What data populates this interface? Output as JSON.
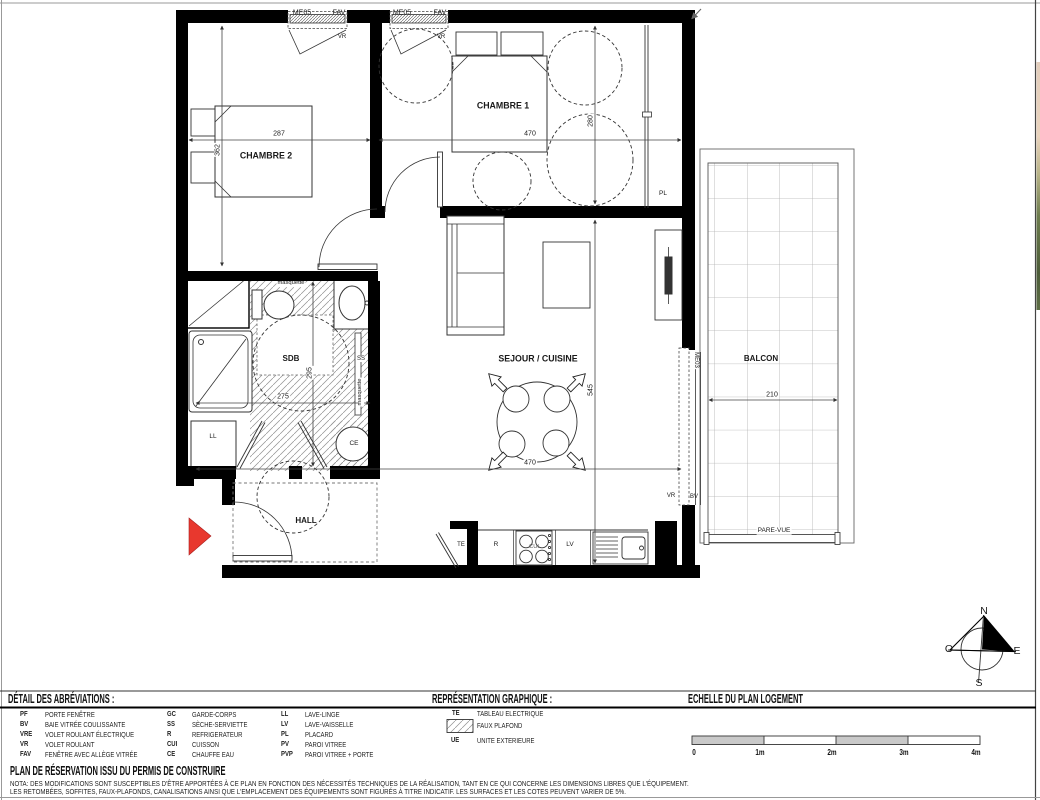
{
  "plan": {
    "windows": {
      "w1_code": "ME05",
      "w1_type": "FAV",
      "w1_shutter": "VR",
      "w2_code": "ME05",
      "w2_type": "FAV",
      "w2_shutter": "VR",
      "balcony_door_code": "ME03",
      "balcony_door_shutter": "VR",
      "balcony_door_type": "BV"
    },
    "rooms": {
      "chambre1": "CHAMBRE 1",
      "chambre2": "CHAMBRE 2",
      "sdb": "SDB",
      "sejour_cuisine": "SEJOUR / CUISINE",
      "hall": "HALL",
      "balcon": "BALCON"
    },
    "dims_cm": {
      "chambre1_width": "470",
      "chambre1_depth": "280",
      "chambre2_width": "287",
      "chambre2_depth": "362",
      "sdb_width": "275",
      "sdb_depth": "295",
      "sejour_width": "470",
      "sejour_depth": "545",
      "balcon_width": "210"
    },
    "equipment": {
      "placard": "PL",
      "seche_serviette": "SS",
      "lave_linge": "LL",
      "chauffe_eau": "CE",
      "tableau_electrique": "TE",
      "refrigerateur": "R",
      "cuisson": "CUI",
      "lave_vaisselle": "LV"
    },
    "annotations": {
      "masquette_top": "masquette",
      "masquette_side": "masquette",
      "pare_vue": "PARE-VUE"
    }
  },
  "compass": {
    "north": "N",
    "west": "O",
    "east": "E",
    "south": "S"
  },
  "legend": {
    "abbreviations_title": "DÉTAIL DES ABRÉVIATIONS :",
    "graphics_title": "REPRÉSENTATION GRAPHIQUE :",
    "scale_title": "ECHELLE DU PLAN LOGEMENT",
    "abbreviations": [
      {
        "code": "PF",
        "label": "PORTE  FENÊTRE"
      },
      {
        "code": "BV",
        "label": "BAIE VITRÉE COULISSANTE"
      },
      {
        "code": "VRE",
        "label": "VOLET ROULANT ÉLECTRIQUE"
      },
      {
        "code": "VR",
        "label": "VOLET ROULANT"
      },
      {
        "code": "FAV",
        "label": "FENÊTRE AVEC ALLÈGE VITRÉE"
      },
      {
        "code": "GC",
        "label": "GARDE-CORPS"
      },
      {
        "code": "SS",
        "label": "SÈCHE-SERVIETTE"
      },
      {
        "code": "R",
        "label": "REFRIGERATEUR"
      },
      {
        "code": "CUI",
        "label": "CUISSON"
      },
      {
        "code": "CE",
        "label": "CHAUFFE EAU"
      },
      {
        "code": "LL",
        "label": "LAVE-LINGE"
      },
      {
        "code": "LV",
        "label": "LAVE-VAISSELLE"
      },
      {
        "code": "PL",
        "label": "PLACARD"
      },
      {
        "code": "PV",
        "label": "PAROI VITREE"
      },
      {
        "code": "PVP",
        "label": "PAROI VITREE + PORTE"
      }
    ],
    "graphics": {
      "te_code": "TE",
      "te_label": "TABLEAU ELECTRIQUE",
      "faux_plafond_label": "FAUX PLAFOND",
      "ue_code": "UE",
      "ue_label": "UNITE EXTERIEURE"
    },
    "scale_ticks": [
      "0",
      "1m",
      "2m",
      "3m",
      "4m"
    ]
  },
  "footer": {
    "title": "PLAN DE RÉSERVATION ISSU DU PERMIS DE CONSTRUIRE",
    "nota_line1": "NOTA: DES MODIFICATIONS SONT SUSCEPTIBLES D'ÊTRE APPORTÉES À CE PLAN EN FONCTION DES NÉCESSITÉS TECHNIQUES DE LA RÉALISATION, TANT EN CE QUI CONCERNE LES DIMENSIONS LIBRES QUE L'ÉQUIPEMENT.",
    "nota_line2": "LES RETOMBÉES, SOFFITES, FAUX-PLAFONDS, CANALISATIONS AINSI QUE L'EMPLACEMENT DES ÉQUIPEMENTS SONT FIGURÉS À TITRE INDICATIF. LES SURFACES ET LES COTES PEUVENT VARIER DE 5%."
  }
}
